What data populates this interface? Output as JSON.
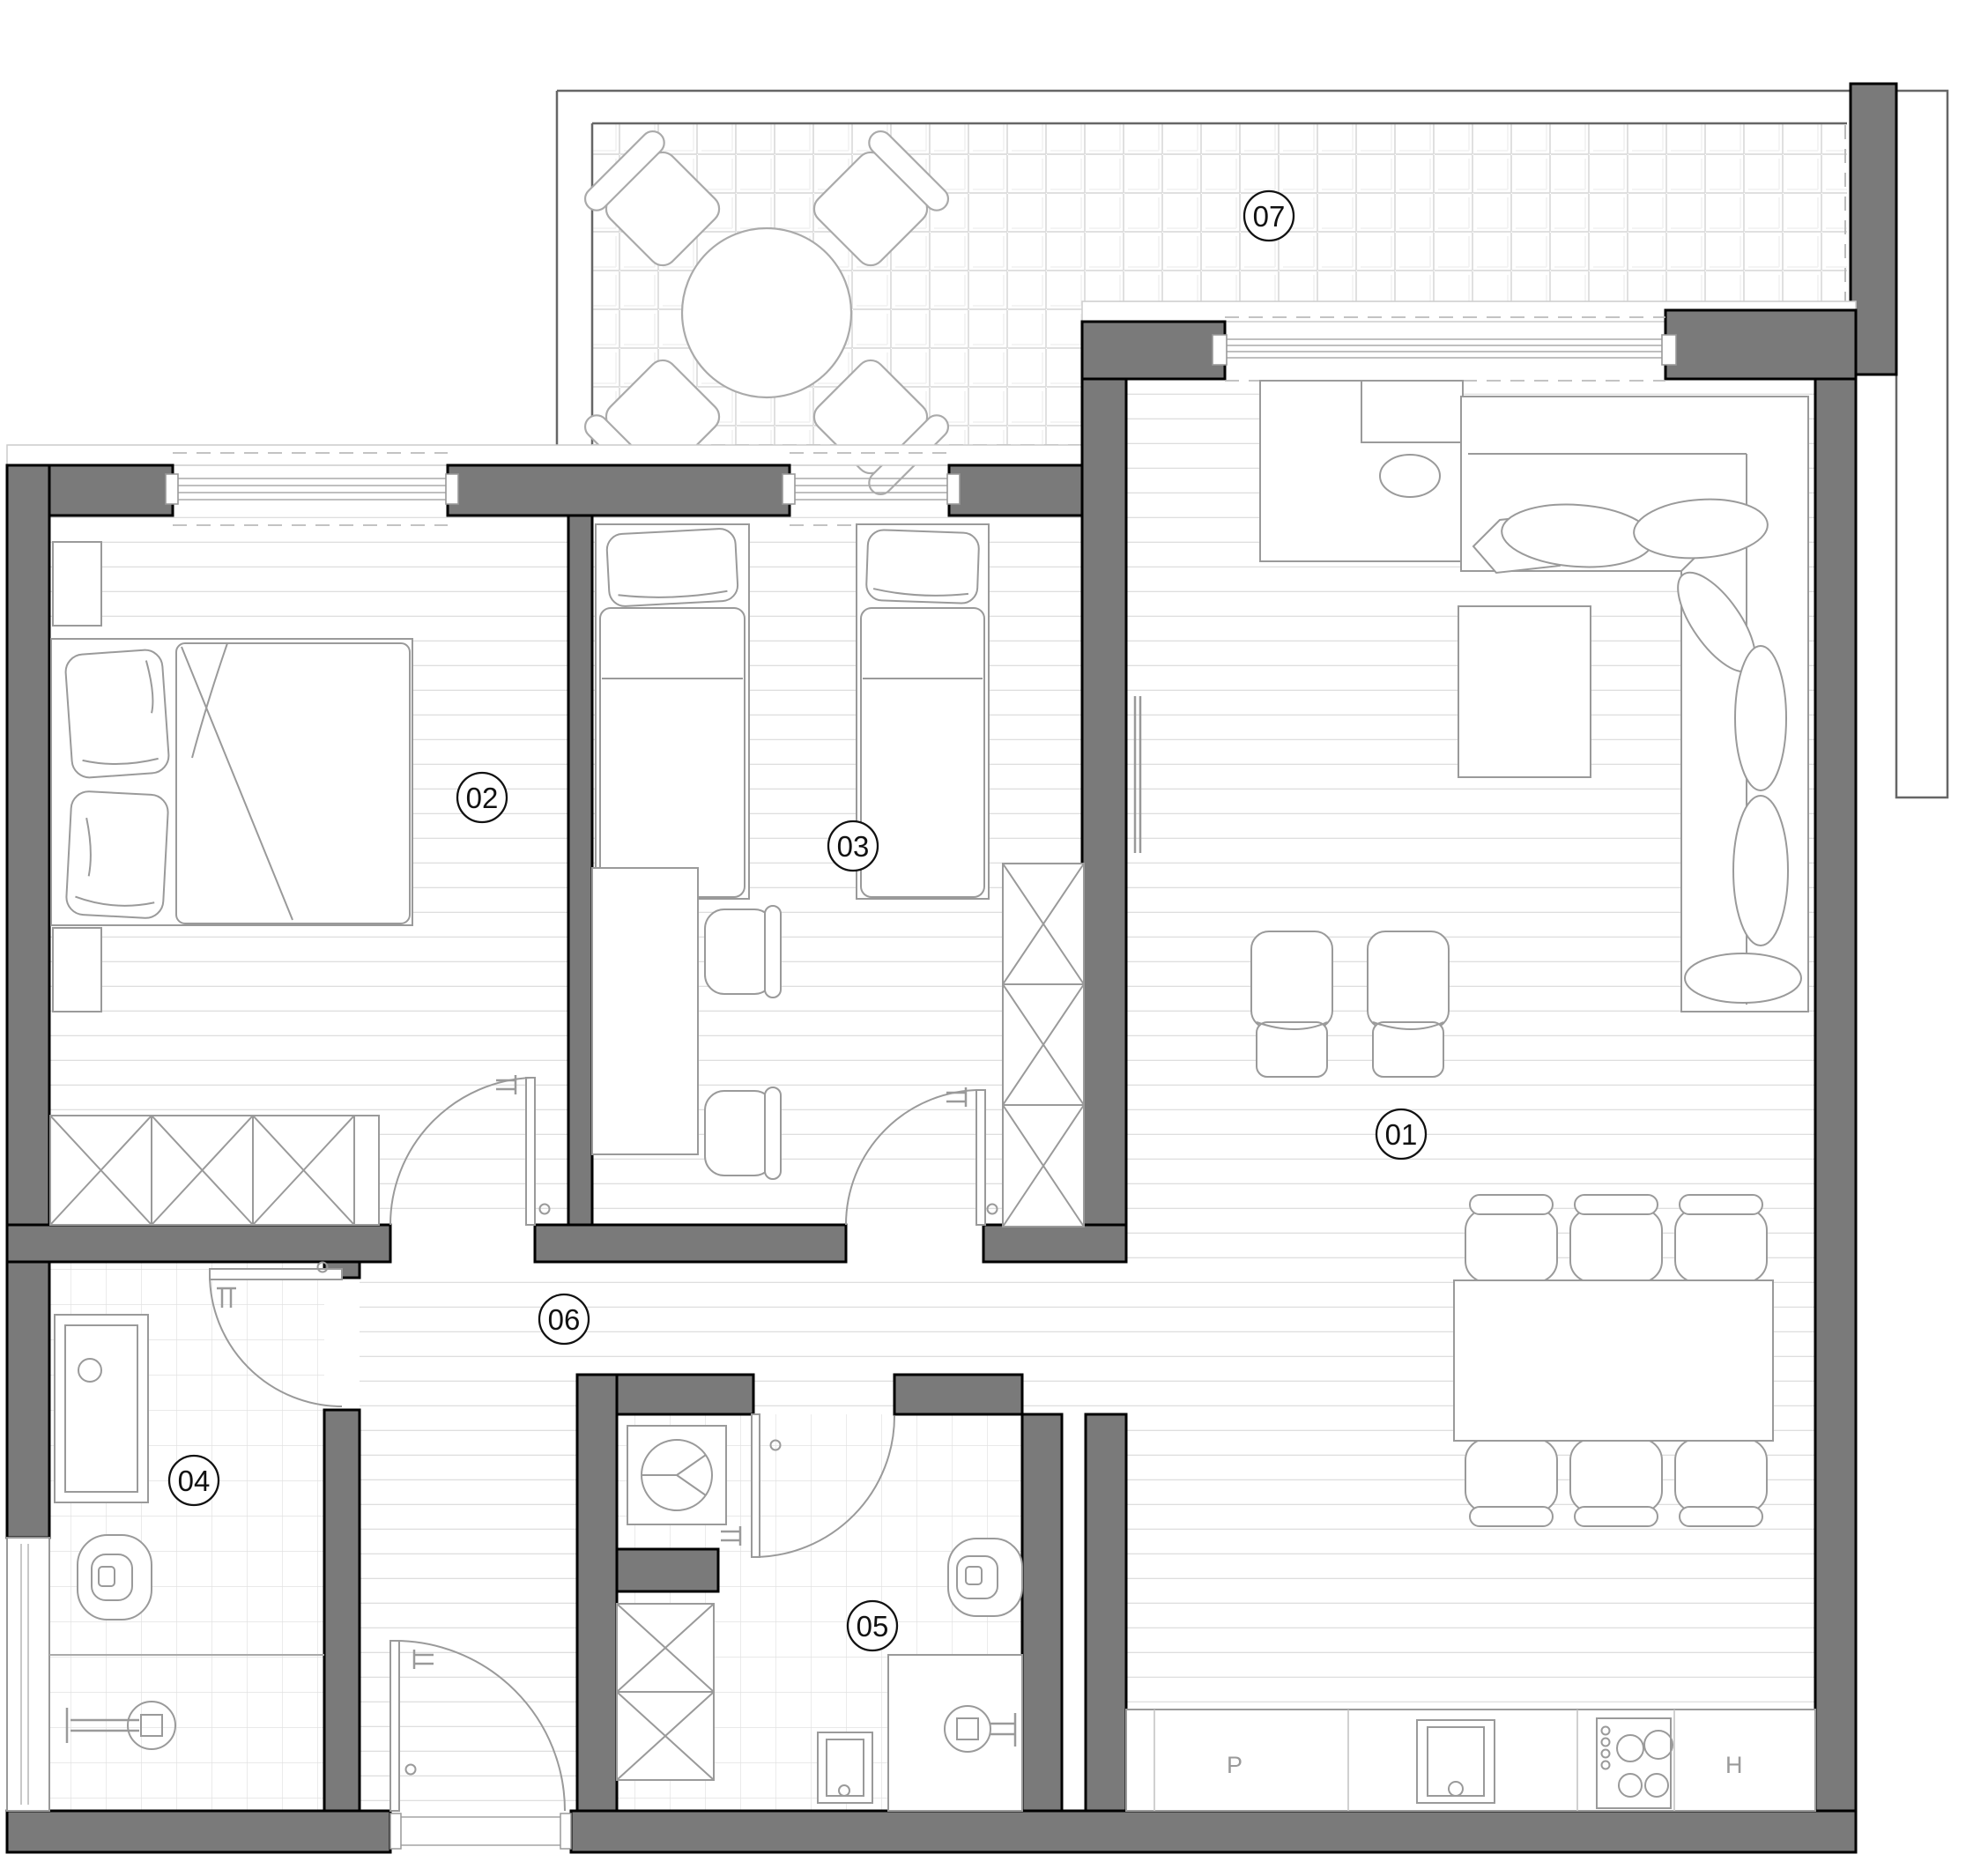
{
  "labels": {
    "r01": "01",
    "r02": "02",
    "r03": "03",
    "r04": "04",
    "r05": "05",
    "r06": "06",
    "r07": "07",
    "p": "P",
    "h": "H"
  },
  "rooms": [
    {
      "label": "01",
      "furniture": [
        "corner-sofa",
        "console",
        "coffee-table",
        "armchair",
        "armchair",
        "radiator",
        "dining-table",
        "six-chairs",
        "kitchen-counter",
        "sink",
        "stove",
        "dishwasher-P",
        "fridge-H"
      ]
    },
    {
      "label": "02",
      "furniture": [
        "double-bed",
        "pillows",
        "nightstand",
        "nightstand",
        "wardrobe-3x"
      ]
    },
    {
      "label": "03",
      "furniture": [
        "single-bed",
        "single-bed",
        "desk",
        "chair",
        "chair",
        "wardrobe-3x"
      ]
    },
    {
      "label": "04",
      "furniture": [
        "vanity-sink",
        "toilet",
        "shower"
      ]
    },
    {
      "label": "05",
      "furniture": [
        "washing-machine",
        "closet-2x",
        "toilet",
        "shower",
        "basin"
      ]
    },
    {
      "label": "06",
      "furniture": [
        "entrance-door"
      ]
    },
    {
      "label": "07",
      "furniture": [
        "round-table",
        "four-chairs"
      ]
    }
  ],
  "colors": {
    "wall": "#7a7a7a",
    "wall_outline": "#000000",
    "furniture_line": "#9a9a9a",
    "wood_floor_line": "#dedede",
    "tile_line": "#e2e2e2",
    "label_text": "#111111",
    "appliance_text": "#9a9a9a"
  }
}
